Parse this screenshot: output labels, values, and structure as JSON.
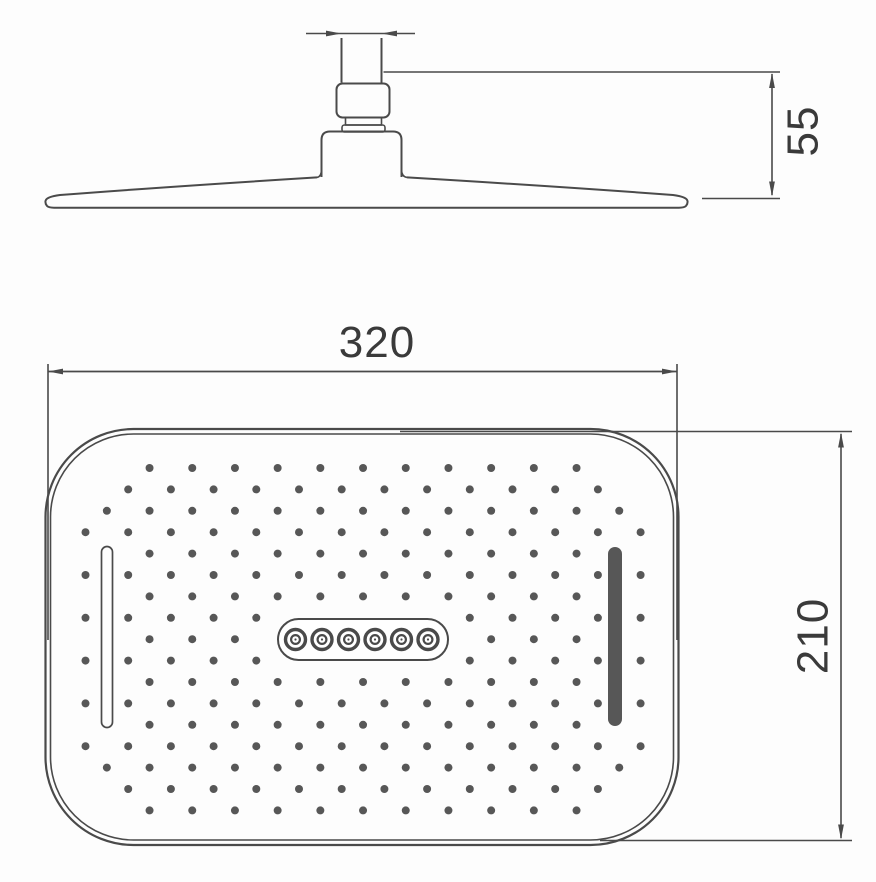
{
  "document": {
    "type": "technical-drawing",
    "subject": "overhead rain shower head - side elevation (top) and spray face (bottom) views"
  },
  "colors": {
    "line": "#4a4a4a",
    "text": "#3a3a3a",
    "dot": "#575757",
    "slot_fill": "#575757",
    "background": "#fdfdfd"
  },
  "dimensions": {
    "face_width_label": "320",
    "face_height_label": "210",
    "head_depth_label": "55"
  },
  "face_pattern": {
    "rows": 17,
    "cols": 27,
    "origin_x": 85.5,
    "origin_y": 468,
    "col_spacing": 21.35,
    "row_spacing": 21.4,
    "dot_radius": 4,
    "window": {
      "x": 83,
      "y": 462,
      "w": 561,
      "h": 354,
      "r": 78
    },
    "exclusions": [
      {
        "name": "left-slot",
        "x": 95,
        "y": 537,
        "w": 25,
        "h": 200
      },
      {
        "name": "right-slot",
        "x": 601,
        "y": 537,
        "w": 30,
        "h": 200
      },
      {
        "name": "center-nozzle-capsule",
        "x": 269,
        "y": 610,
        "w": 188,
        "h": 59
      }
    ],
    "nozzle_cluster": {
      "count": 6,
      "start_x": 295.5,
      "spacing": 26.5,
      "center_y": 639.5,
      "outer_r": 10,
      "mid_r": 4.4,
      "core_r": 1.1
    }
  }
}
